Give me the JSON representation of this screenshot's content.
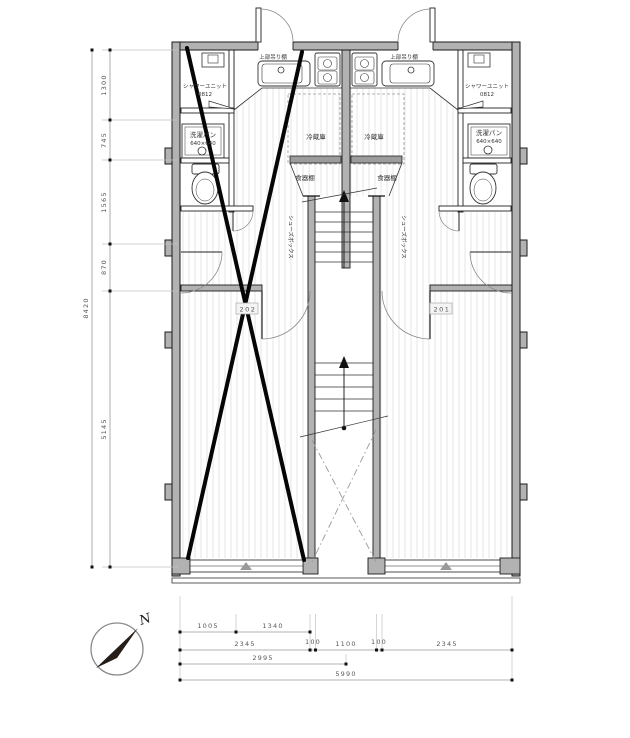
{
  "plan": {
    "unit_left": {
      "room_number": "202",
      "hanging_shelf": "上部吊り棚",
      "fridge": "冷蔵庫",
      "cupboard": "食器棚",
      "shoebox": "シューズボックス",
      "shower_line1": "シャワーユニット",
      "shower_line2": "0812",
      "washer_line1": "洗濯パン",
      "washer_line2": "640×640"
    },
    "unit_right": {
      "room_number": "201",
      "hanging_shelf": "上部吊り棚",
      "fridge": "冷蔵庫",
      "cupboard": "食器棚",
      "shoebox": "シューズボックス",
      "shower_line1": "シャワーユニット",
      "shower_line2": "0812",
      "washer_line1": "洗濯パン",
      "washer_line2": "640×640"
    }
  },
  "dimensions": {
    "vertical_segments": [
      "1300",
      "745",
      "1565",
      "870",
      "5145"
    ],
    "vertical_overall": "8420",
    "bottom_row1": [
      "1005",
      "1340"
    ],
    "bottom_row2": [
      "2345",
      "100",
      "1100",
      "100",
      "2345"
    ],
    "bottom_row3": "2995",
    "bottom_overall": "5990"
  },
  "compass": {
    "north": "N"
  },
  "colors": {
    "wall_fill": "#b2b2b2",
    "outline": "#1b1b1b",
    "hatch": "#dedede",
    "dim_line": "#9a9a9a",
    "dim_text": "#585858",
    "cross_mark": "#060606",
    "needle": "#241d18"
  }
}
